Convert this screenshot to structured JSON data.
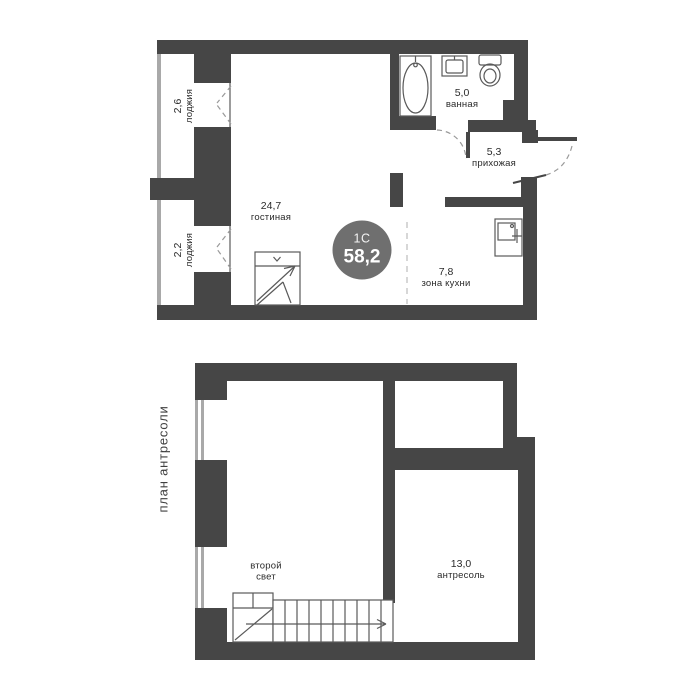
{
  "plan_main": {
    "badge": {
      "plan_type": "1С",
      "total_area": "58,2"
    },
    "rooms": [
      {
        "id": "loggia-top",
        "line1": "2,6",
        "line2": "лоджия"
      },
      {
        "id": "loggia-bottom",
        "line1": "2,2",
        "line2": "лоджия"
      },
      {
        "id": "living-room",
        "line1": "24,7",
        "line2": "гостиная"
      },
      {
        "id": "kitchen-zone",
        "line1": "7,8",
        "line2": "зона кухни"
      },
      {
        "id": "bathroom",
        "line1": "5,0",
        "line2": "ванная"
      },
      {
        "id": "hallway",
        "line1": "5,3",
        "line2": "прихожая"
      }
    ]
  },
  "plan_mezzanine": {
    "side_title": "план антресоли",
    "rooms": [
      {
        "id": "second-light",
        "line1": "второй",
        "line2": "свет"
      },
      {
        "id": "mezzanine",
        "line1": "13,0",
        "line2": "антресоль"
      }
    ]
  },
  "icons": {
    "bathtub": "bathtub-icon",
    "sink": "sink-icon",
    "toilet": "toilet-icon",
    "kitchen_sink": "kitchen-sink-icon",
    "stairs_main": "stairs-up-icon",
    "stairs_mezzanine": "stairs-run-icon",
    "bathroom_door": "door-swing-arc-icon",
    "entry_door": "entry-door-swing-icon",
    "balcony_window": "window-casement-icon"
  },
  "colors": {
    "wall": "#464646",
    "wall_light": "#a9a9a9",
    "badge_bg": "#6f6f6f",
    "badge_text": "#ffffff",
    "label_text": "#2b2b2b",
    "fixture_line": "#5a5a5a",
    "dash_line": "#9a9a9a"
  }
}
